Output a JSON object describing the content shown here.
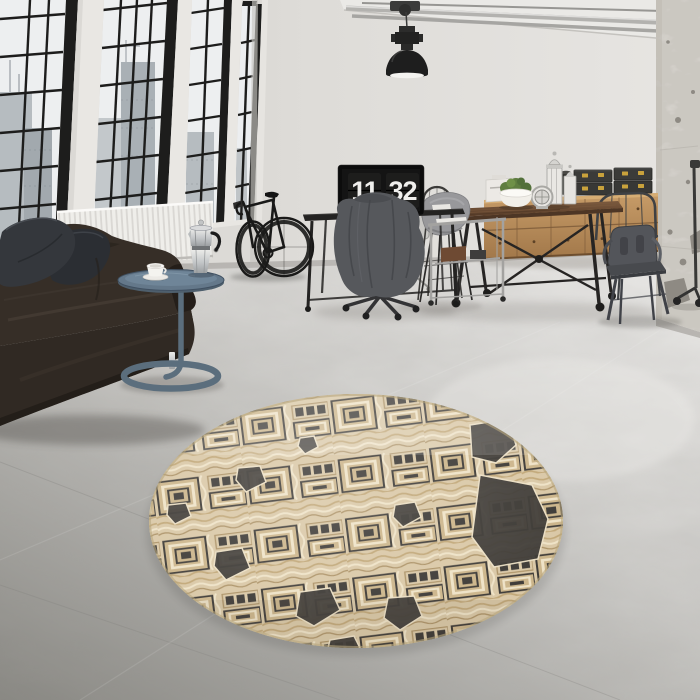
{
  "meta": {
    "description": "Photograph of an industrial loft interior: black factory windows, dark leather sofa, round side table with moka pot and cup, bicycle against the wall, desk monitor showing a flip clock, industrial pendant lamp, wooden dining table with metal chairs, wooden sideboard with storage chests, distressed plaster column, and a round beige tribal-pattern rug on a polished concrete floor."
  },
  "clock": {
    "hours": "11",
    "minutes": "32"
  },
  "palette": {
    "wall": "#dbd8d4",
    "ceiling": "#e9e8e5",
    "window_frame": "#1d1d1c",
    "glass": "#eef0f1",
    "city_buildings": "#aeb4b8",
    "radiator": "#f0efec",
    "floor_near": "#8f8e8a",
    "floor_far": "#eceae7",
    "sofa_leather": "#372f28",
    "pillows": "#33363b",
    "side_table": "#5f7383",
    "moka_pot": "#c7cacc",
    "coffee_cup": "#f6f5f2",
    "bicycle": "#191918",
    "pendant_lamp": "#1f1f1f",
    "monitor": "#0d0d0d",
    "clock_digits": "#f0efed",
    "jacket": "#56585c",
    "table_wood": "#6a4a32",
    "iron_legs": "#262423",
    "sideboard_wood": "#b78c5b",
    "storage_boxes": "#3b3b39",
    "box_clasps": "#c9a23c",
    "plant_moss": "#5f7d40",
    "gray_chair": "#98989b",
    "metal_chairs": "#4a4c4f",
    "column_plaster": "#eae7e2",
    "rug_base": "#d9c7a5",
    "rug_cream": "#ecdfc2",
    "rug_tan": "#bda47a",
    "rug_dark": "#3b3834"
  }
}
